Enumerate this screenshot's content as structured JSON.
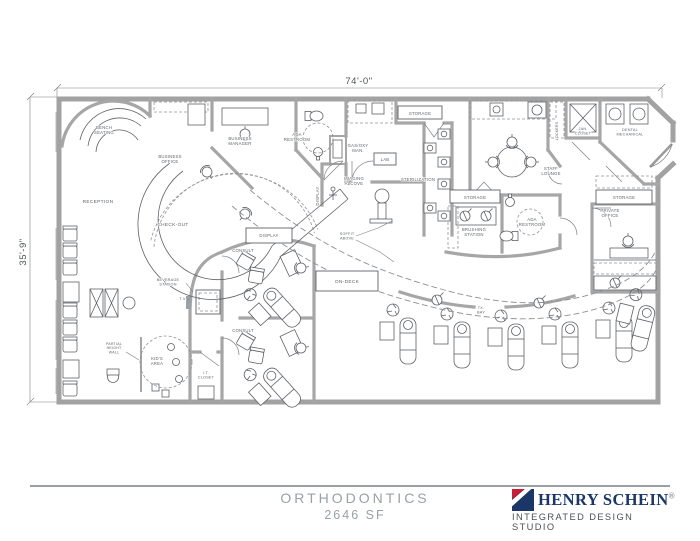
{
  "dimensions": {
    "width_label": "74'-0\"",
    "height_label": "35'-9\""
  },
  "rooms": {
    "bench_seating": "BENCH\nSEATING",
    "business_office": "BUSINESS\nOFFICE",
    "business_manager": "BUSINESS\nMANAGER",
    "reception": "RECEPTION",
    "check_out": "CHECK-OUT",
    "ada_restroom_1": "ADA\nRESTROOM",
    "gas_oxy": "GAS/OXY\nMAN.",
    "lab": "LAB",
    "imaging_alcove": "IMAGING\nALCOVE",
    "display_wall": "DISPLAY",
    "storage_top": "STORAGE",
    "sterilization": "STERILIZATION",
    "staff_lounge": "STAFF\nLOUNGE",
    "lockers": "LOCKERS",
    "jan_closet": "JAN.\nCLOSET",
    "dental_mechanical": "DENTAL\nMECHANICAL",
    "storage_mid": "STORAGE",
    "brushing_station": "BRUSHING\nSTATION",
    "ada_restroom_2": "ADA\nRESTROOM",
    "storage_right": "STORAGE",
    "private_office": "PRIVATE\nOFFICE",
    "display_consult": "DISPLAY",
    "consult_1": "CONSULT",
    "consult_2": "CONSULT",
    "on_deck": "ON-DECK",
    "it_closet": "I.T.\nCLOSET",
    "soffit_above": "SOFFIT\nABOVE",
    "beverage_station": "BEVERAGE\nSTATION",
    "tv": "T.V.",
    "kids_area": "KID'S\nAREA",
    "partial_height_wall": "PARTIAL\nHEIGHT\nWALL",
    "tx_bay": "TX.\nBAY"
  },
  "title_block": {
    "project": "ORTHODONTICS",
    "area": "2646 SF"
  },
  "brand": {
    "name": "HENRY SCHEIN",
    "registered": "®",
    "tagline": "INTEGRATED DESIGN STUDIO",
    "navy": "#1b3767",
    "red": "#c81f36"
  }
}
